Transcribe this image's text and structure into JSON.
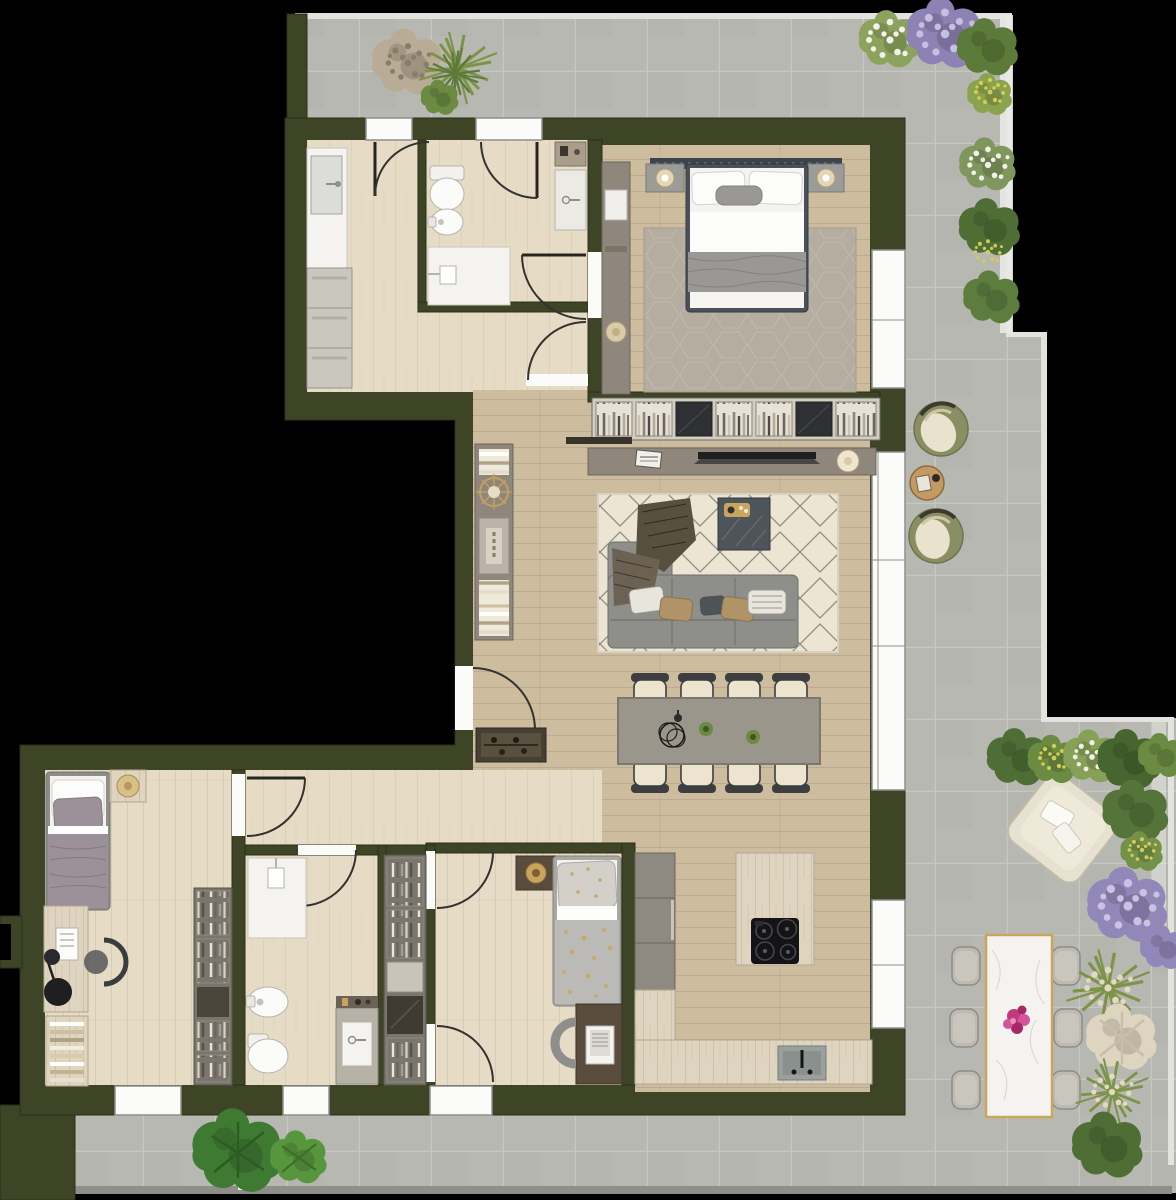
{
  "meta": {
    "kind": "residential-floor-plan",
    "view": "top-down-render",
    "text_labels": []
  },
  "palette": {
    "background": "#000000",
    "wall": "#3e4527",
    "wallEdge": "#2a3018",
    "terraceTile": "#b7b8b2",
    "tileGrout": "#c6c7c1",
    "railing": "#e2e3dd",
    "terraceEdge": "#8e8f89",
    "floorWood": "#cebc9f",
    "floorLight": "#e6dcc6",
    "floorBath": "#eae2d1",
    "window": "#fbfbfa",
    "windowFrame": "#8f8f8c",
    "doorArc": "#32322e",
    "rugCream": "#ece5d4",
    "rugLine": "#54524a",
    "rugBedroom": "#b4ada0",
    "sofaGray": "#8e8e8a",
    "tableGray": "#9a968c",
    "seatCream": "#ece4cf",
    "chairDark": "#3c3e3f",
    "woodDark": "#5a4c3c",
    "taupe": "#8f867c",
    "travertine": "#ded4bf",
    "marbleWhite": "#f4f3ef",
    "gold": "#c5a45e",
    "cooktop": "#141417",
    "oliveChair": "#8a8f63",
    "sideTableTan": "#c49a62",
    "loungeCream": "#e7e1d1",
    "green1": "#4f6e35",
    "green2": "#6b8a42",
    "green3": "#86a058",
    "green4": "#3f7a33",
    "lavender": "#9187b8",
    "lavenderLight": "#cac2e4",
    "yellowBloom": "#d3cc55",
    "whiteBloom": "#f0efe6",
    "pampas": "#ddd3bd",
    "flowerMagenta": "#c23a7e",
    "bedWhite": "#f4f3f0",
    "blanketGray": "#9a9895",
    "blanketMauve": "#9c9099",
    "headboardNavy": "#3c434c",
    "starGold": "#c9a968",
    "dryPlant": "#b9ac97"
  },
  "inventory": {
    "rooms": [
      {
        "id": "laundry-bathroom",
        "features": [
          "sink",
          "counter",
          "stacked-washer-dryer-units"
        ]
      },
      {
        "id": "bathroom-1",
        "features": [
          "toilet",
          "bidet",
          "shower",
          "vanity-sink"
        ]
      },
      {
        "id": "bedroom-1",
        "features": [
          "double-bed",
          "dark-headboard",
          "two-nightstands",
          "lamps",
          "hex-rug",
          "wardrobe"
        ]
      },
      {
        "id": "hallway",
        "features": [
          "console-with-books",
          "sunburst-decor",
          "entry-door",
          "shoe-cabinet"
        ]
      },
      {
        "id": "living-room",
        "features": [
          "sectional-sofa",
          "berber-rug",
          "coffee-table",
          "tv-sideboard",
          "bookshelf-wall"
        ]
      },
      {
        "id": "dining-area",
        "features": [
          "rectangular-table",
          "eight-chairs",
          "centerpiece-bowl",
          "small-plants"
        ]
      },
      {
        "id": "kitchen",
        "features": [
          "island-with-cooktop",
          "sink",
          "travertine-counter",
          "tall-cabinets"
        ]
      },
      {
        "id": "bedroom-2",
        "features": [
          "single-bed",
          "nightstand",
          "desk",
          "stool",
          "chair",
          "ladder-bookshelf",
          "wardrobe-column"
        ]
      },
      {
        "id": "bathroom-2",
        "features": [
          "shower",
          "toilet",
          "bidet",
          "vanity-sink"
        ]
      },
      {
        "id": "walk-in-closet",
        "features": [
          "wardrobe-shelving"
        ]
      },
      {
        "id": "bedroom-3",
        "features": [
          "single-bed-star-duvet",
          "nightstand",
          "desk",
          "laptop",
          "chair"
        ]
      },
      {
        "id": "terrace",
        "features": [
          "two-olive-lounge-chairs",
          "round-side-table",
          "cream-armchair",
          "outdoor-dining-table-for-6",
          "magenta-flower-centerpiece",
          "planters",
          "lavender",
          "grasses",
          "shrubs"
        ]
      }
    ]
  }
}
